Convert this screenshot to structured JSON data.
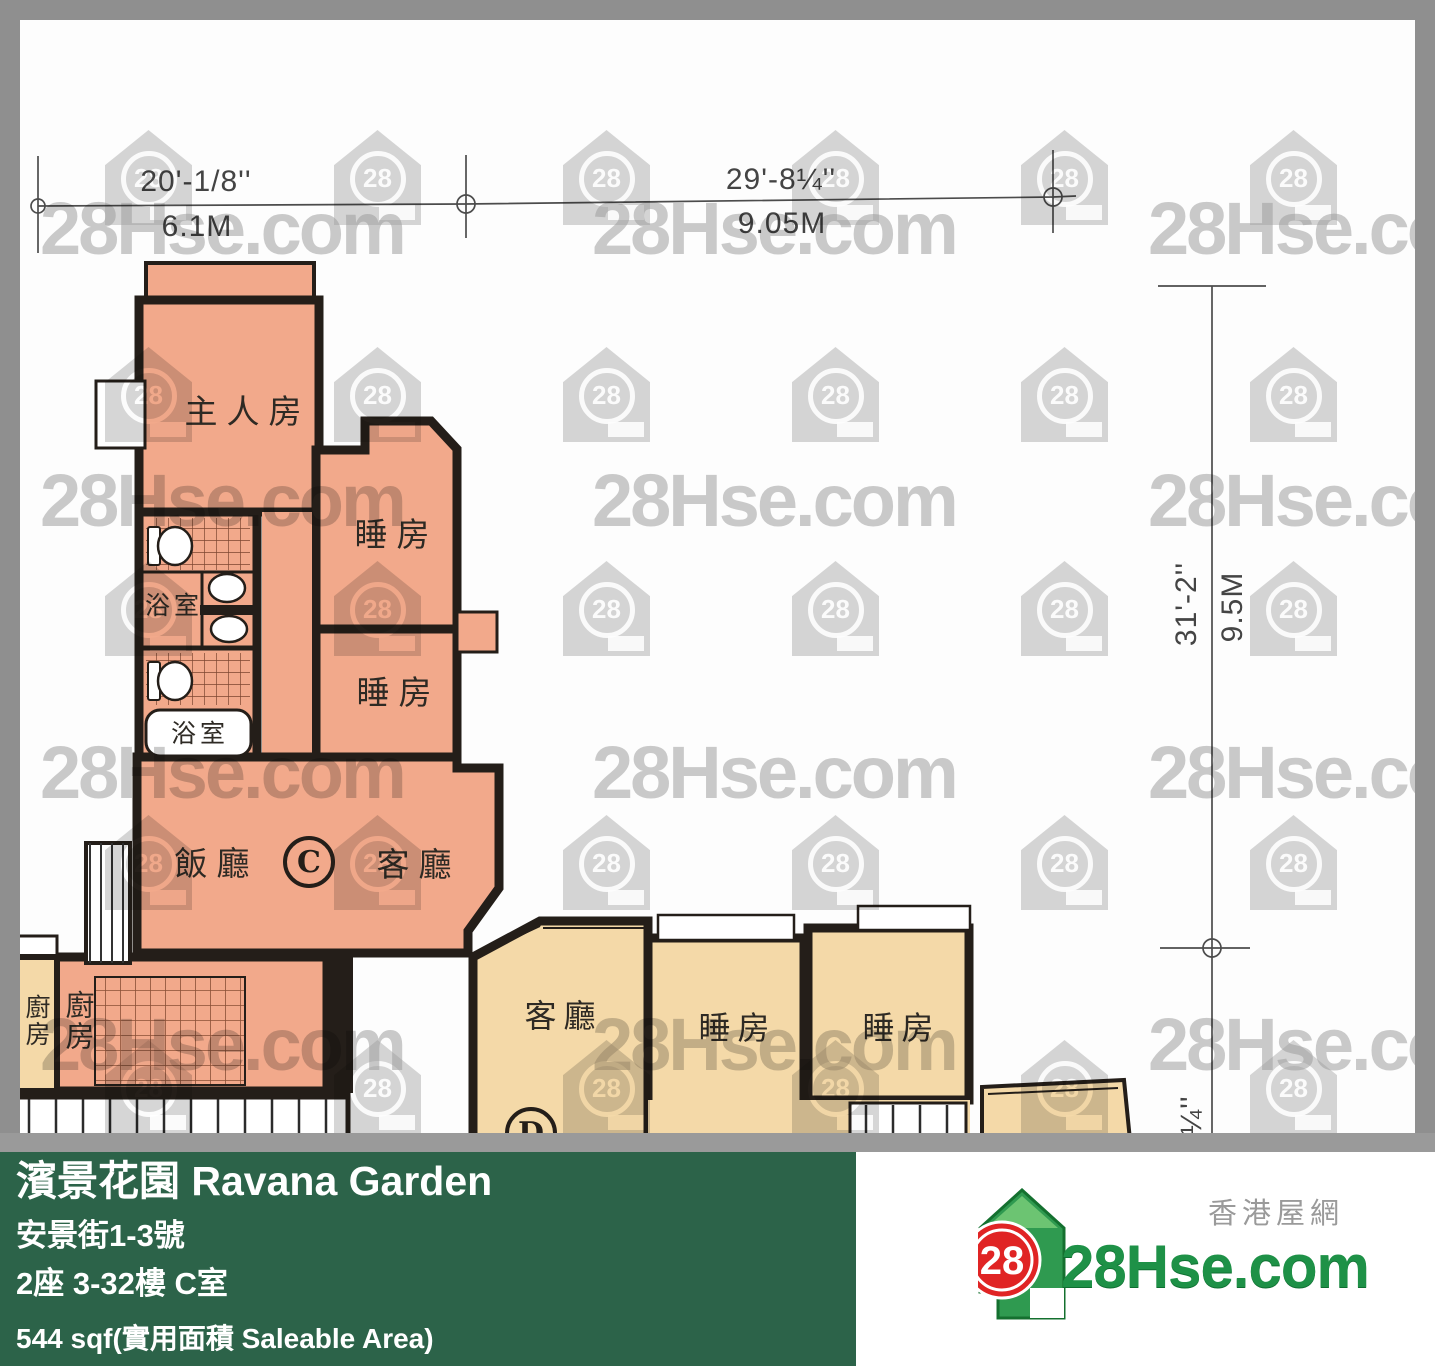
{
  "plan": {
    "dimensions": {
      "top1_ft": "20'-1/8''",
      "top1_m": "6.1M",
      "top2_ft": "29'-8¼''",
      "top2_m": "9.05M",
      "right_ft": "31'-2''",
      "right_m": "9.5M",
      "bottom_partial": "4¼''"
    },
    "unit_c": {
      "label": "C",
      "rooms": {
        "master": "主人房",
        "bed1": "睡房",
        "bed2": "睡房",
        "bath1": "浴室",
        "bath2": "浴室",
        "dining": "飯廳",
        "living": "客廳",
        "kitchen": "廚房"
      }
    },
    "unit_d": {
      "label": "D",
      "rooms": {
        "living": "客廳",
        "bed1": "睡房",
        "bed2": "睡房"
      }
    },
    "neighbor_kitchen": "廚房",
    "watermark": {
      "text": "28Hse.com",
      "badge": "28",
      "text_cols": [
        40,
        592,
        1148
      ],
      "text_rows": [
        186,
        458,
        730,
        1002
      ],
      "house_cols": [
        105,
        334,
        563,
        792,
        1021,
        1250
      ],
      "house_rows": [
        130,
        347,
        561,
        815,
        1040
      ]
    }
  },
  "footer": {
    "title": "濱景花園 Ravana Garden",
    "address": "安景街1-3號",
    "unit": "2座 3-32樓 C室",
    "area": "544 sqf(實用面積 Saleable Area)"
  },
  "logo": {
    "badge": "28",
    "brand": "28Hse.com",
    "tagline": "香港屋網"
  }
}
